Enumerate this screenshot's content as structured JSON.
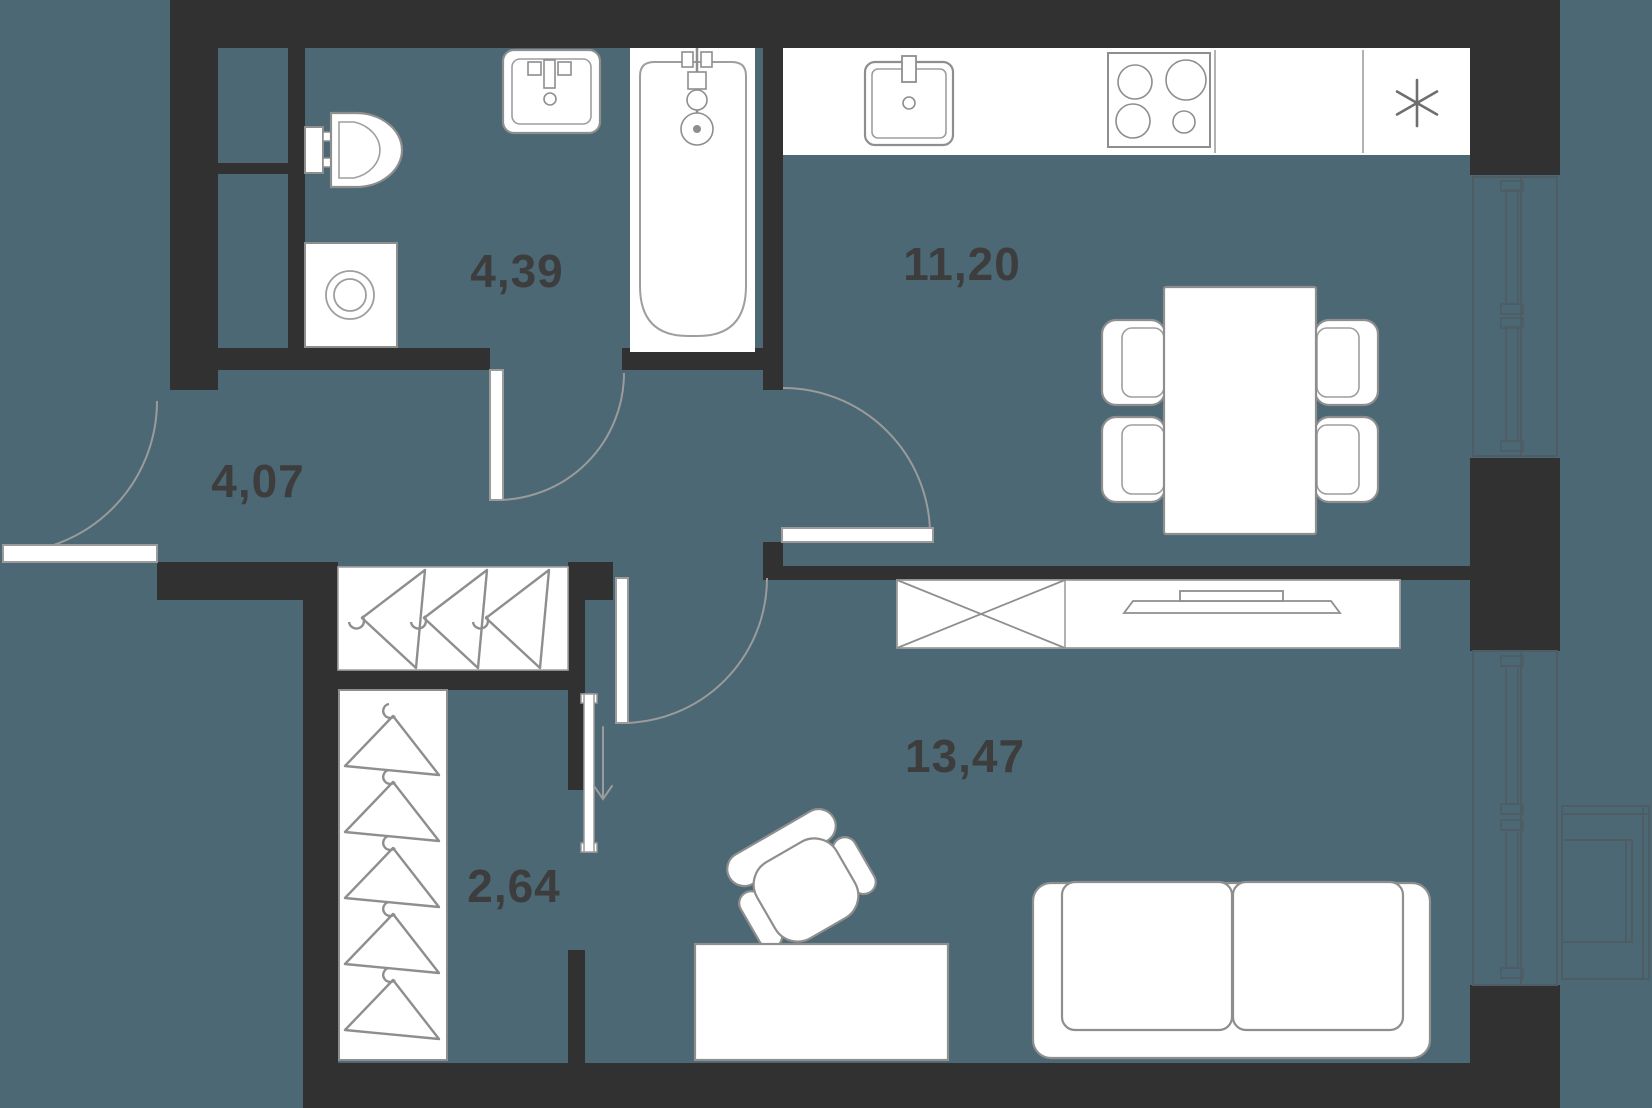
{
  "floor_plan": {
    "type": "apartment-floor-plan",
    "rooms": [
      {
        "name": "bathroom",
        "area": "4,39"
      },
      {
        "name": "kitchen",
        "area": "11,20"
      },
      {
        "name": "hallway",
        "area": "4,07"
      },
      {
        "name": "wardrobe",
        "area": "2,64"
      },
      {
        "name": "living-room",
        "area": "13,47"
      }
    ],
    "colors": {
      "background": "#4b6874",
      "walls": "#313131",
      "fixtures_fill": "#ffffff",
      "fixtures_outline": "#8e8e8e",
      "door_swing": "#9b9b9b",
      "window_lines": "#4e5c64",
      "labels": "#3d3d3d"
    }
  }
}
